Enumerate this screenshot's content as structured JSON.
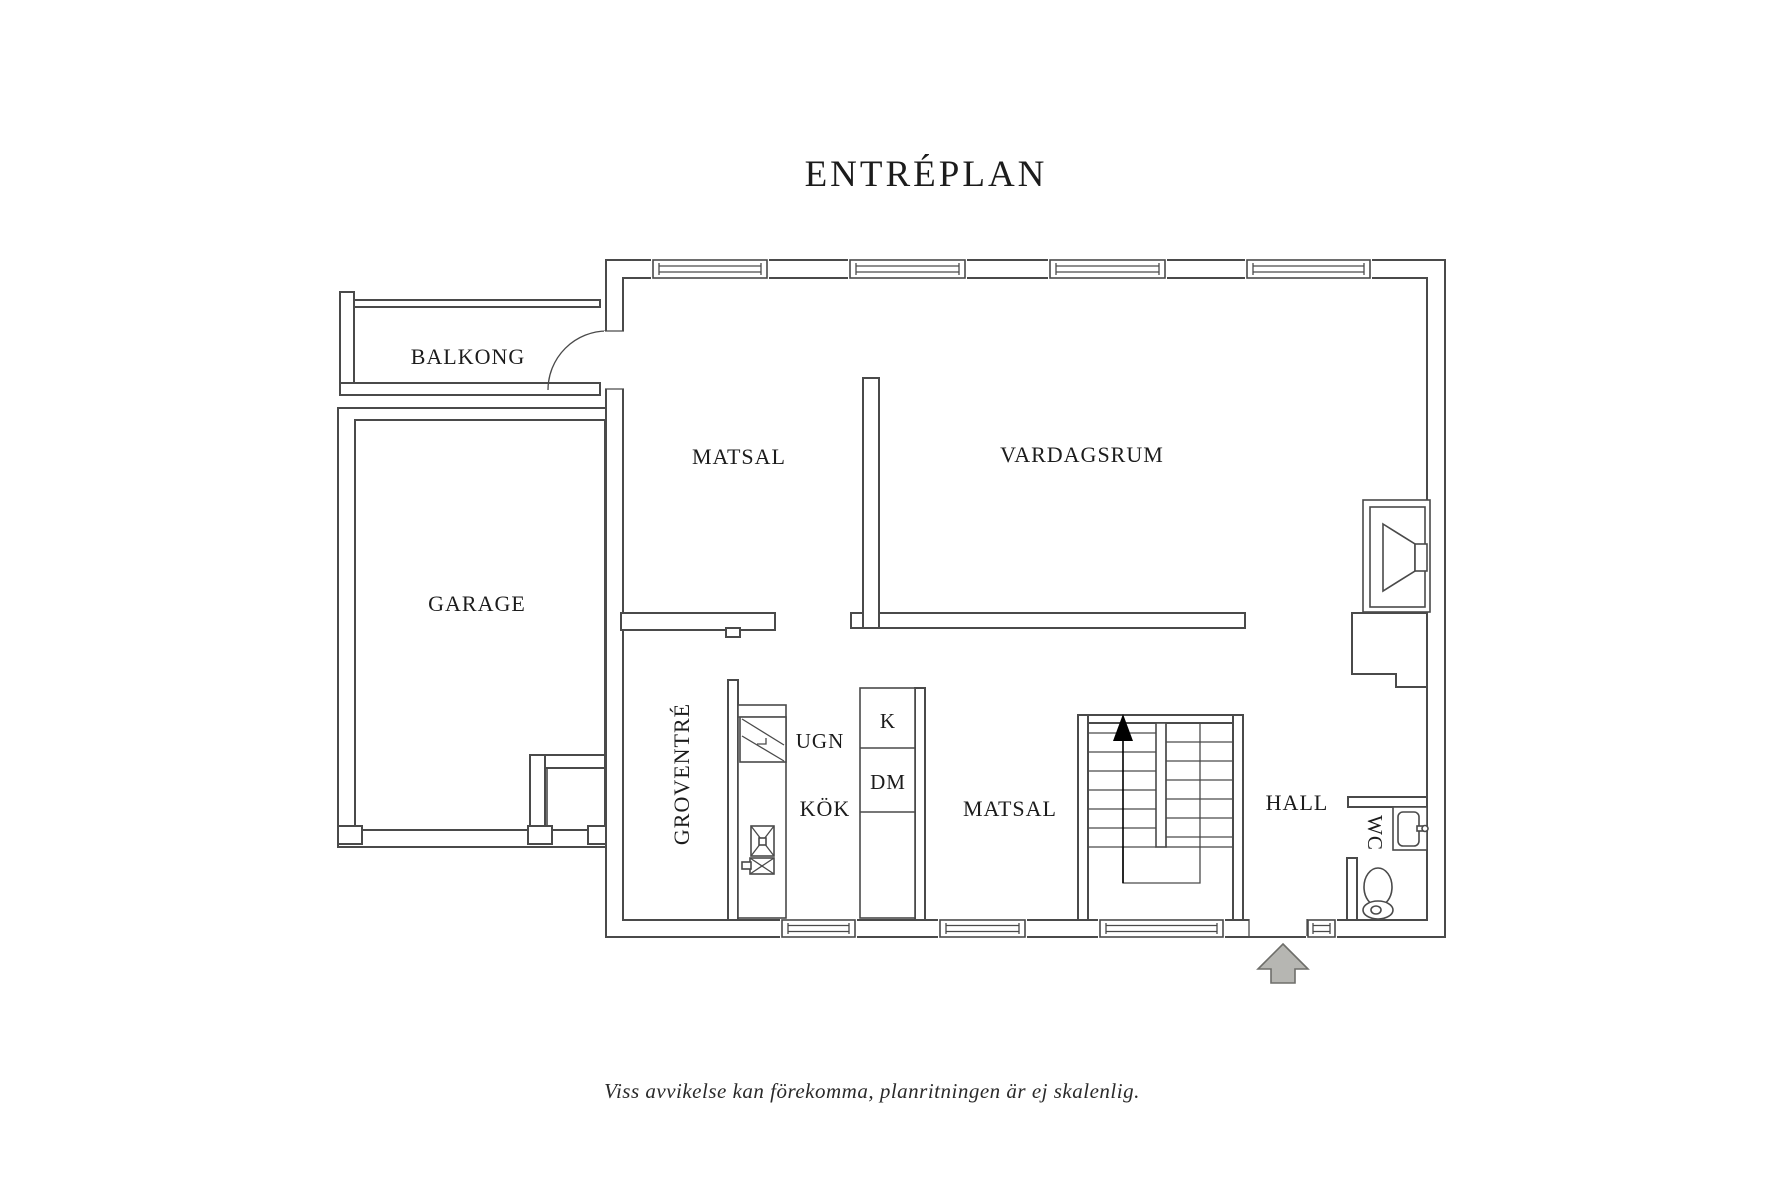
{
  "title": "ENTRÉPLAN",
  "rooms": {
    "balkong": {
      "label": "BALKONG"
    },
    "garage": {
      "label": "GARAGE"
    },
    "matsal_upper": {
      "label": "MATSAL"
    },
    "vardagsrum": {
      "label": "VARDAGSRUM"
    },
    "groventre": {
      "label": "GROVENTRÉ"
    },
    "kok": {
      "label": "KÖK"
    },
    "matsal_lower": {
      "label": "MATSAL"
    },
    "hall": {
      "label": "HALL"
    },
    "wc": {
      "label": "WC"
    }
  },
  "appliances": {
    "ugn": {
      "label": "UGN"
    },
    "kyl": {
      "label": "K"
    },
    "diskmaskin": {
      "label": "DM"
    }
  },
  "icons": {
    "entrance_arrow": "arrow-up-entrance",
    "stairs_arrow": "arrow-up-stairs",
    "toilet": "toilet-icon",
    "sink": "sink-icon",
    "fireplace": "fireplace-icon",
    "oven": "oven-icon",
    "hob": "hob-icon",
    "window": "window-icon"
  },
  "disclaimer": "Viss avvikelse kan förekomma, planritningen är ej skalenlig.",
  "colors": {
    "wall_line": "#4a4a4a",
    "text": "#1c1c1c",
    "arrow_fill": "#b6b6b2",
    "arrow_stroke": "#6e6e6a",
    "direction_arrow": "#000000"
  }
}
